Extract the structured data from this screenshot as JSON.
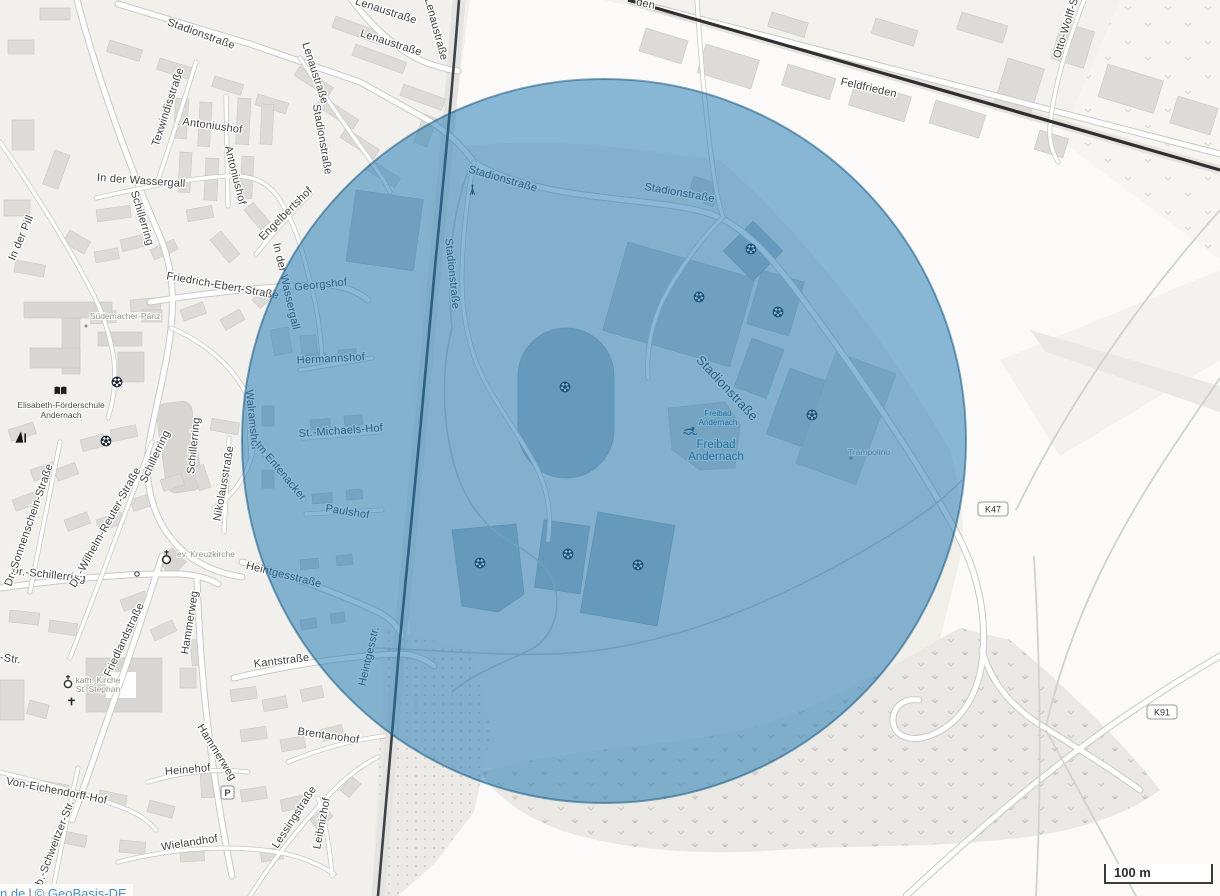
{
  "map": {
    "attribution": {
      "text_fragment": "n.de",
      "separator": "|",
      "source": "© GeoBasis-DE"
    },
    "scale_bar": {
      "label": "100 m"
    },
    "road_shields": [
      {
        "label": "K47"
      },
      {
        "label": "K91"
      }
    ],
    "overlay": {
      "fill": "rgba(30,120,180,0.52)",
      "stroke": "rgba(20,85,130,0.55)"
    },
    "street_labels": [
      {
        "text": "Lenaustraße"
      },
      {
        "text": "Lenaustraße"
      },
      {
        "text": "Lenaustraße"
      },
      {
        "text": "Lenaustraße"
      },
      {
        "text": "Stadionstraße"
      },
      {
        "text": "Stadionstraße"
      },
      {
        "text": "Stadionstraße"
      },
      {
        "text": "Stadionstraße"
      },
      {
        "text": "Stadionstraße"
      },
      {
        "text": "Stadionstraße"
      },
      {
        "text": "Texwindisstraße"
      },
      {
        "text": "Antoniushof"
      },
      {
        "text": "Antoniushof"
      },
      {
        "text": "In der Wassergall"
      },
      {
        "text": "In der Wassergall"
      },
      {
        "text": "Schillerring"
      },
      {
        "text": "Schillerring"
      },
      {
        "text": "Schillerring"
      },
      {
        "text": "Dr.-Schillerring"
      },
      {
        "text": "In der Pill"
      },
      {
        "text": "Friedrich-Ebert-Straße"
      },
      {
        "text": "Georgshof"
      },
      {
        "text": "Engelbertshof"
      },
      {
        "text": "Dr.-Sonnenschein-Straße"
      },
      {
        "text": "Dr.-Wilhelm-Reuter-Straße"
      },
      {
        "text": "Nikolausstraße"
      },
      {
        "text": "Walramshof"
      },
      {
        "text": "Im Entenacker"
      },
      {
        "text": "Hermannshof"
      },
      {
        "text": "St.-Michaels-Hof"
      },
      {
        "text": "Paulshof"
      },
      {
        "text": "Heintgesstraße"
      },
      {
        "text": "Heintgesstr."
      },
      {
        "text": "Kantstraße"
      },
      {
        "text": "Friedlandstraße"
      },
      {
        "text": "Hammerweg"
      },
      {
        "text": "Hammerweg"
      },
      {
        "text": "Heinehof"
      },
      {
        "text": "Brentanohof"
      },
      {
        "text": "Lessingstraße"
      },
      {
        "text": "Leibnizhof"
      },
      {
        "text": "Wielandhof"
      },
      {
        "text": "Von-Eichendorff-Hof"
      },
      {
        "text": "b.-Schweitzer-Str."
      },
      {
        "text": "Feldfrieden"
      },
      {
        "text": "Otto-Wolff-S"
      },
      {
        "text": "den"
      },
      {
        "text": "-Str."
      }
    ],
    "poi_labels": {
      "suedemacher": "Südemacher-Pänz",
      "school_line1": "Elisabeth-Förderschule",
      "school_line2": "Andernach",
      "kreuzkirche": "ev. Kreuzkirche",
      "kath_line1": "kath. Kirche",
      "kath_line2": "St. Stephan",
      "trampolino": "Trampolino",
      "parking": "P",
      "freibad_small_line1": "Freibad",
      "freibad_small_line2": "Andernach",
      "freibad_big_line1": "Freibad",
      "freibad_big_line2": "Andernach"
    }
  }
}
